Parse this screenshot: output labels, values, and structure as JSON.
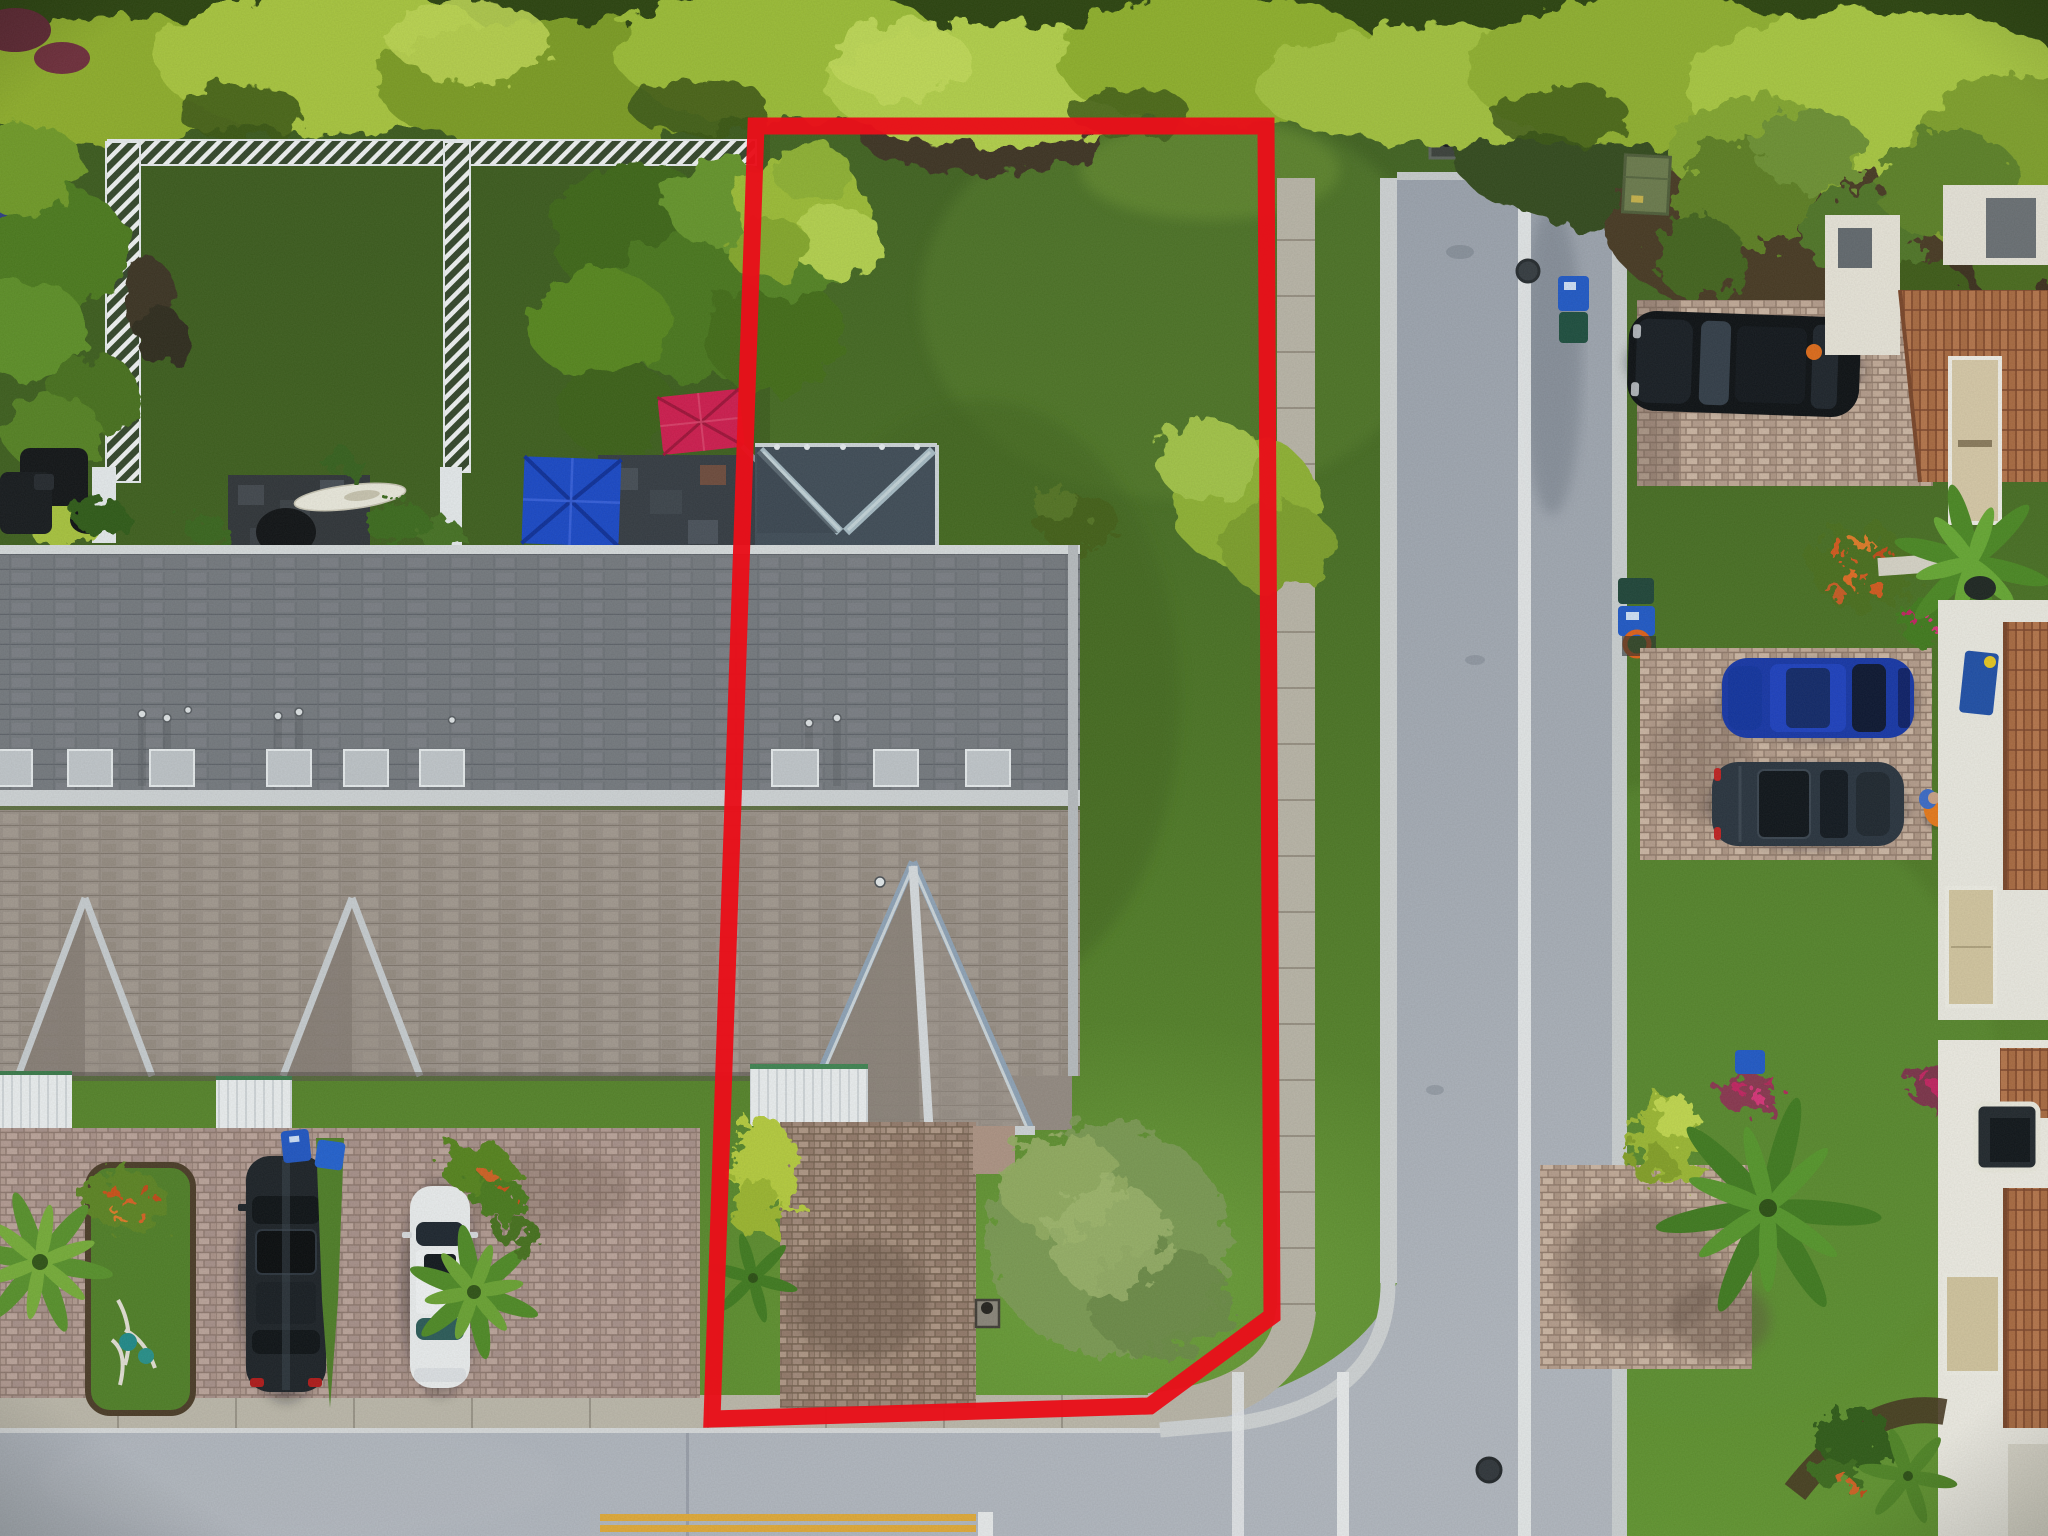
{
  "meta": {
    "kind": "aerial-drone-real-estate-photo",
    "description": "Top-down drone photograph of a townhouse community; subject corner lot outlined in red, bordered by a T-street intersection, neighboring townhouse roofs, driveways with parked cars, tropical tree canopy at top",
    "width_px": 2048,
    "height_px": 1536
  },
  "annotation": {
    "boundary_points": "756,126 1266,126 1272,1316 1150,1406 712,1419",
    "boundary_color": "#e8101a",
    "boundary_stroke_width": "17"
  },
  "palette": {
    "grass_dark": "#3d5d1e",
    "grass_mid": "#4a7323",
    "grass_bright": "#61952f",
    "canopy_light": "#b3d04a",
    "canopy_mid": "#8fae2b",
    "canopy_dark": "#2c430f",
    "mulch_brown": "#463824",
    "roof_upper_slope": "#75797f",
    "roof_lower_slope": "#9b9189",
    "roof_ridge": "#d0d4d7",
    "porch_roof_dark": "#3f4b57",
    "awning_white": "#edf0f2",
    "paver_left": "#b49b93",
    "paver_subject": "#a2897a",
    "paver_right": "#c3aa98",
    "sidewalk_concrete": "#bab5a8",
    "curb_white": "#d0d3d5",
    "road_asphalt": "#a4aab4",
    "lane_line_white": "#e9ebed",
    "center_line_yellow": "#e2aa38",
    "fence_white": "#f2f4f5",
    "trampoline_navy": "#2b3c85",
    "umbrella_red": "#d01a4e",
    "canopy_blue": "#1847c8",
    "suv_black": "#1b2026",
    "sedan_white": "#eceef0",
    "sedan_blue": "#1535a8",
    "suv_gray_blue": "#28323e",
    "spanish_tile": "#b5744a",
    "vest_orange": "#e87818",
    "utility_box_green": "#6b7a4c",
    "recycle_bin_blue": "#1f55c4"
  },
  "objects": {
    "boundary": "red property outline around subject corner lot",
    "trampoline": "backyard trampoline, left edge",
    "lattice_fences": "white lattice privacy fences between backyards",
    "red_patio_umbrella": "crimson patio umbrella in neighbor backyard",
    "blue_canopy": "royal blue patio canopy at roof edge",
    "kayak": "white kayak on dark slate patio",
    "townhouse_roof": "long shingled townhouse roof with skylights and gable dormers",
    "subject_gable": "subject unit projecting front gable",
    "black_suv_front": "dark SUV parked in front driveway",
    "white_sedan_front": "white sedan parked in front driveway",
    "landscape_island": "grass island with palm, flowers, driftwood garden art",
    "vertical_street": "street along right side of subject lot",
    "bottom_street": "street along bottom with double yellow center line",
    "manholes": "two dark manhole covers on streets",
    "storm_drain": "square storm drain at street top",
    "green_utility_box": "green utility cabinet on right verge",
    "recycle_bins": "blue curbside recycle bins",
    "right_black_suv": "black SUV on upper right driveway",
    "right_blue_sedan": "royal blue sedan on middle right driveway",
    "right_gray_suv": "dark gray SUV on middle right driveway",
    "worker": "person in orange safety vest on right driveway",
    "spanish_roof_buildings": "white buildings with Spanish barrel-tile roofs, far right",
    "palms": "palm trees along driveways",
    "wispy_bush": "feathery sage-green shrub on subject front lawn"
  }
}
